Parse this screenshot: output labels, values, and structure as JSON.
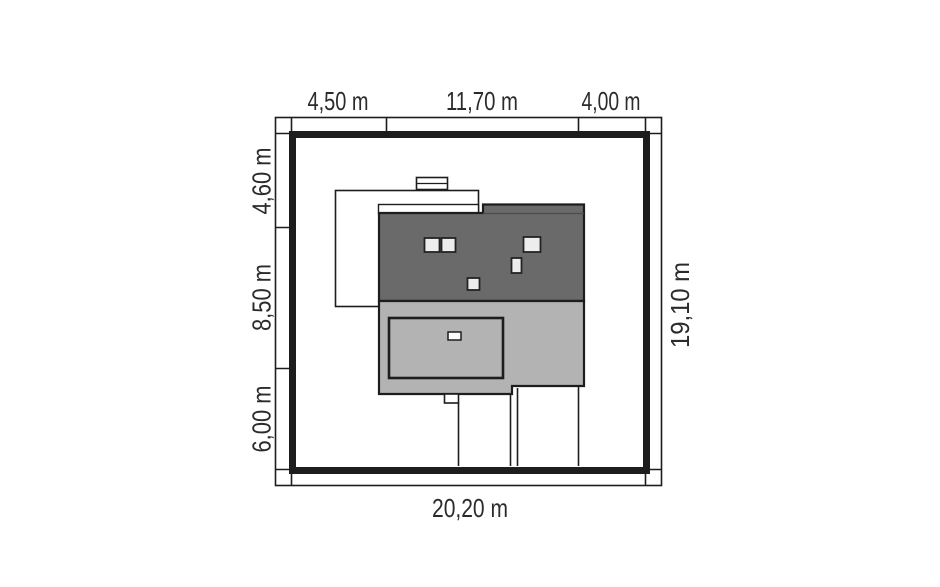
{
  "plan": {
    "kind": "house-site-plan-top-view",
    "dimensions": {
      "top": [
        "4,50 m",
        "11,70 m",
        "4,00 m"
      ],
      "left": [
        "4,60 m",
        "8,50 m",
        "6,00 m"
      ],
      "right": "19,10 m",
      "bottom": "20,20 m"
    },
    "colors": {
      "line": "#1d1d1d",
      "roof_dark": "#6a6a6a",
      "building_light": "#b3b3b3",
      "skylight_fill": "#ededed",
      "background": "#ffffff",
      "text": "#2b2b2b"
    }
  }
}
